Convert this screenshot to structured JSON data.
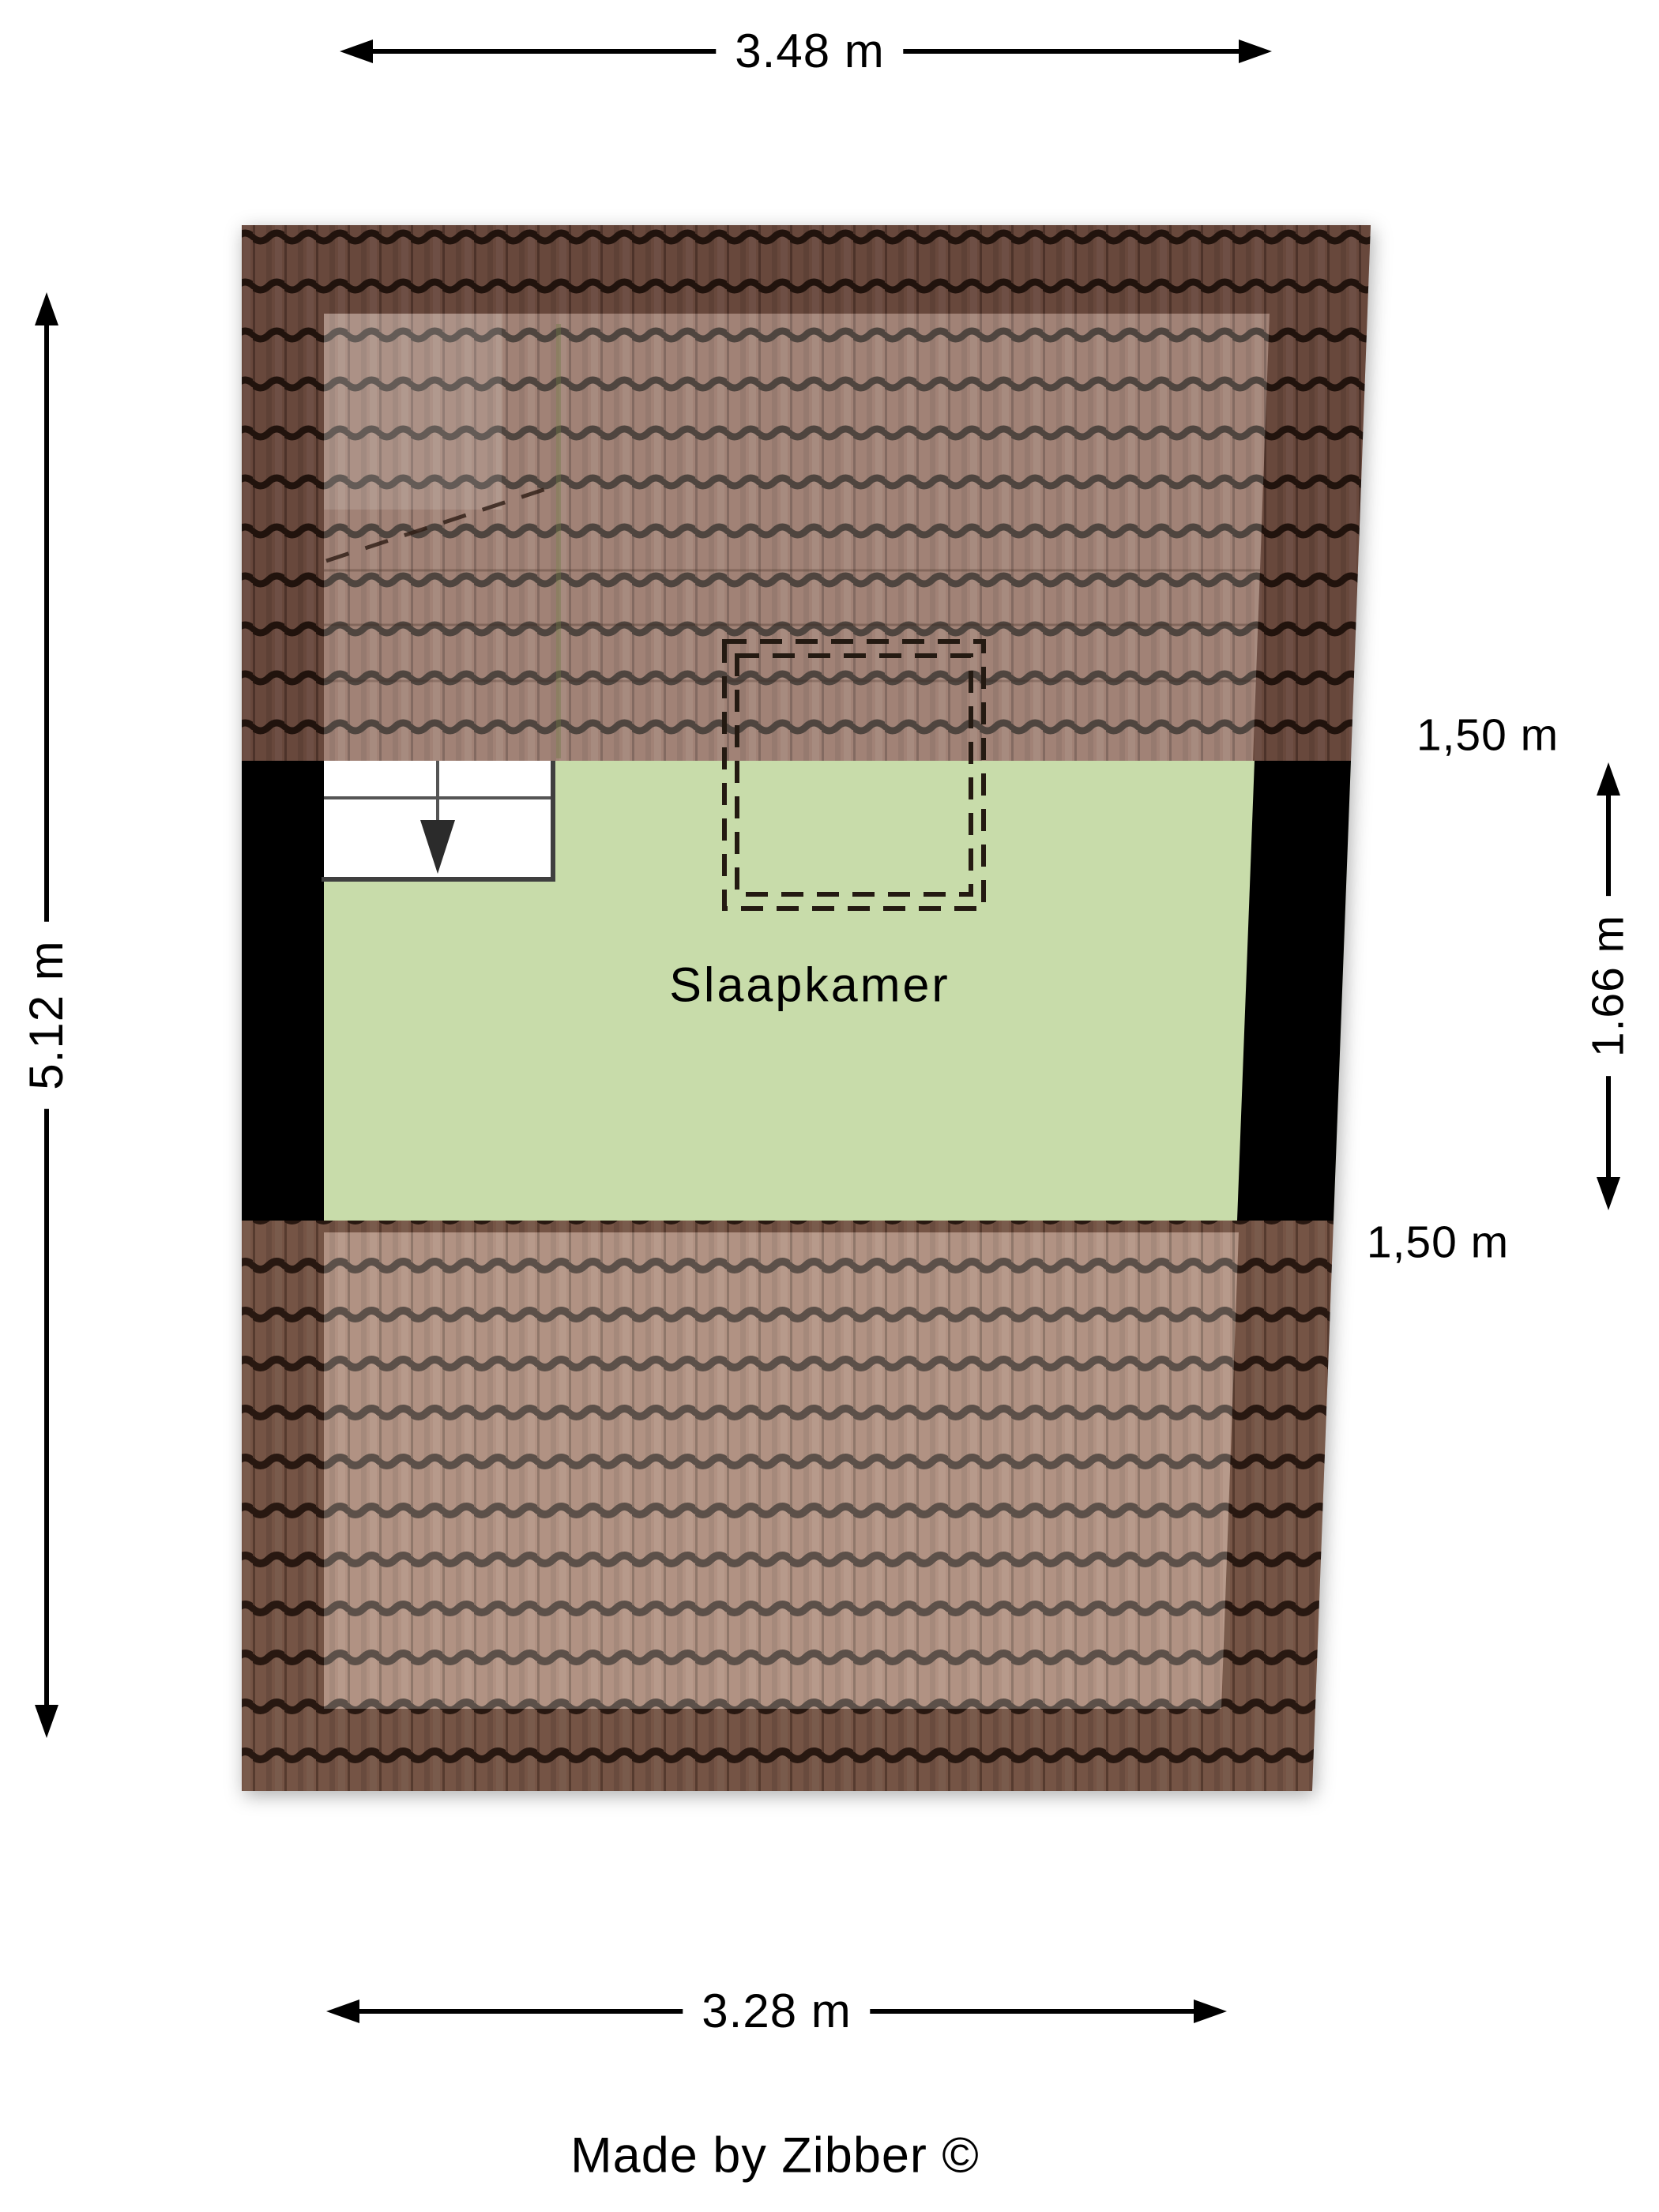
{
  "room": {
    "label": "Slaapkamer"
  },
  "dimensions": {
    "top_width": "3.48 m",
    "left_height": "5.12 m",
    "bottom_width": "3.28 m",
    "right_knee_top": "1,50 m",
    "right_height": "1.66 m",
    "right_knee_bottom": "1,50 m"
  },
  "stairs": {
    "icon": "down-arrow"
  },
  "footer": {
    "credit": "Made by Zibber ©"
  },
  "colors": {
    "room_fill": "#c8dcaa",
    "wall_fill": "#000000",
    "roof_tile_top": "#8a6354",
    "roof_tile_bottom": "#9c7460",
    "tile_line": "#241710",
    "dimension_color": "#000000"
  }
}
